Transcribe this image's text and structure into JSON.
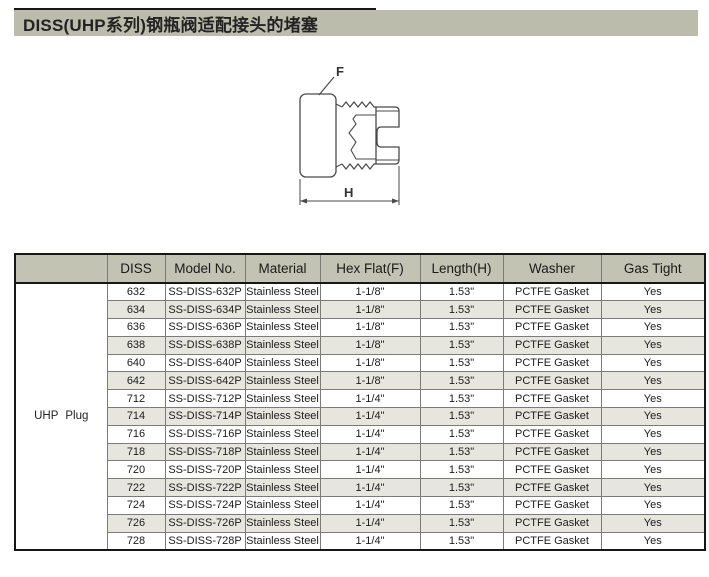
{
  "page": {
    "title": "DISS(UHP系列)钢瓶阀适配接头的堵塞"
  },
  "diagram": {
    "flat_label": "F",
    "length_label": "H"
  },
  "table": {
    "group_label": "UHP Plug",
    "headers": [
      "DISS",
      "Model No.",
      "Material",
      "Hex Flat(F)",
      "Length(H)",
      "Washer",
      "Gas Tight"
    ],
    "rows": [
      [
        "632",
        "SS-DISS-632P",
        "Stainless Steel",
        "1-1/8\"",
        "1.53\"",
        "PCTFE Gasket",
        "Yes"
      ],
      [
        "634",
        "SS-DISS-634P",
        "Stainless Steel",
        "1-1/8\"",
        "1.53\"",
        "PCTFE Gasket",
        "Yes"
      ],
      [
        "636",
        "SS-DISS-636P",
        "Stainless Steel",
        "1-1/8\"",
        "1.53\"",
        "PCTFE Gasket",
        "Yes"
      ],
      [
        "638",
        "SS-DISS-638P",
        "Stainless Steel",
        "1-1/8\"",
        "1.53\"",
        "PCTFE Gasket",
        "Yes"
      ],
      [
        "640",
        "SS-DISS-640P",
        "Stainless Steel",
        "1-1/8\"",
        "1.53\"",
        "PCTFE Gasket",
        "Yes"
      ],
      [
        "642",
        "SS-DISS-642P",
        "Stainless Steel",
        "1-1/8\"",
        "1.53\"",
        "PCTFE Gasket",
        "Yes"
      ],
      [
        "712",
        "SS-DISS-712P",
        "Stainless Steel",
        "1-1/4\"",
        "1.53\"",
        "PCTFE Gasket",
        "Yes"
      ],
      [
        "714",
        "SS-DISS-714P",
        "Stainless Steel",
        "1-1/4\"",
        "1.53\"",
        "PCTFE Gasket",
        "Yes"
      ],
      [
        "716",
        "SS-DISS-716P",
        "Stainless Steel",
        "1-1/4\"",
        "1.53\"",
        "PCTFE Gasket",
        "Yes"
      ],
      [
        "718",
        "SS-DISS-718P",
        "Stainless Steel",
        "1-1/4\"",
        "1.53\"",
        "PCTFE Gasket",
        "Yes"
      ],
      [
        "720",
        "SS-DISS-720P",
        "Stainless Steel",
        "1-1/4\"",
        "1.53\"",
        "PCTFE Gasket",
        "Yes"
      ],
      [
        "722",
        "SS-DISS-722P",
        "Stainless Steel",
        "1-1/4\"",
        "1.53\"",
        "PCTFE Gasket",
        "Yes"
      ],
      [
        "724",
        "SS-DISS-724P",
        "Stainless Steel",
        "1-1/4\"",
        "1.53\"",
        "PCTFE Gasket",
        "Yes"
      ],
      [
        "726",
        "SS-DISS-726P",
        "Stainless Steel",
        "1-1/4\"",
        "1.53\"",
        "PCTFE Gasket",
        "Yes"
      ],
      [
        "728",
        "SS-DISS-728P",
        "Stainless Steel",
        "1-1/4\"",
        "1.53\"",
        "PCTFE Gasket",
        "Yes"
      ]
    ]
  },
  "colors": {
    "band_bg": "#bcbcad",
    "header_bg": "#c3c3b4",
    "row_alt_bg": "#e6e6df",
    "grid_line": "#7b7b78",
    "frame": "#161616"
  }
}
